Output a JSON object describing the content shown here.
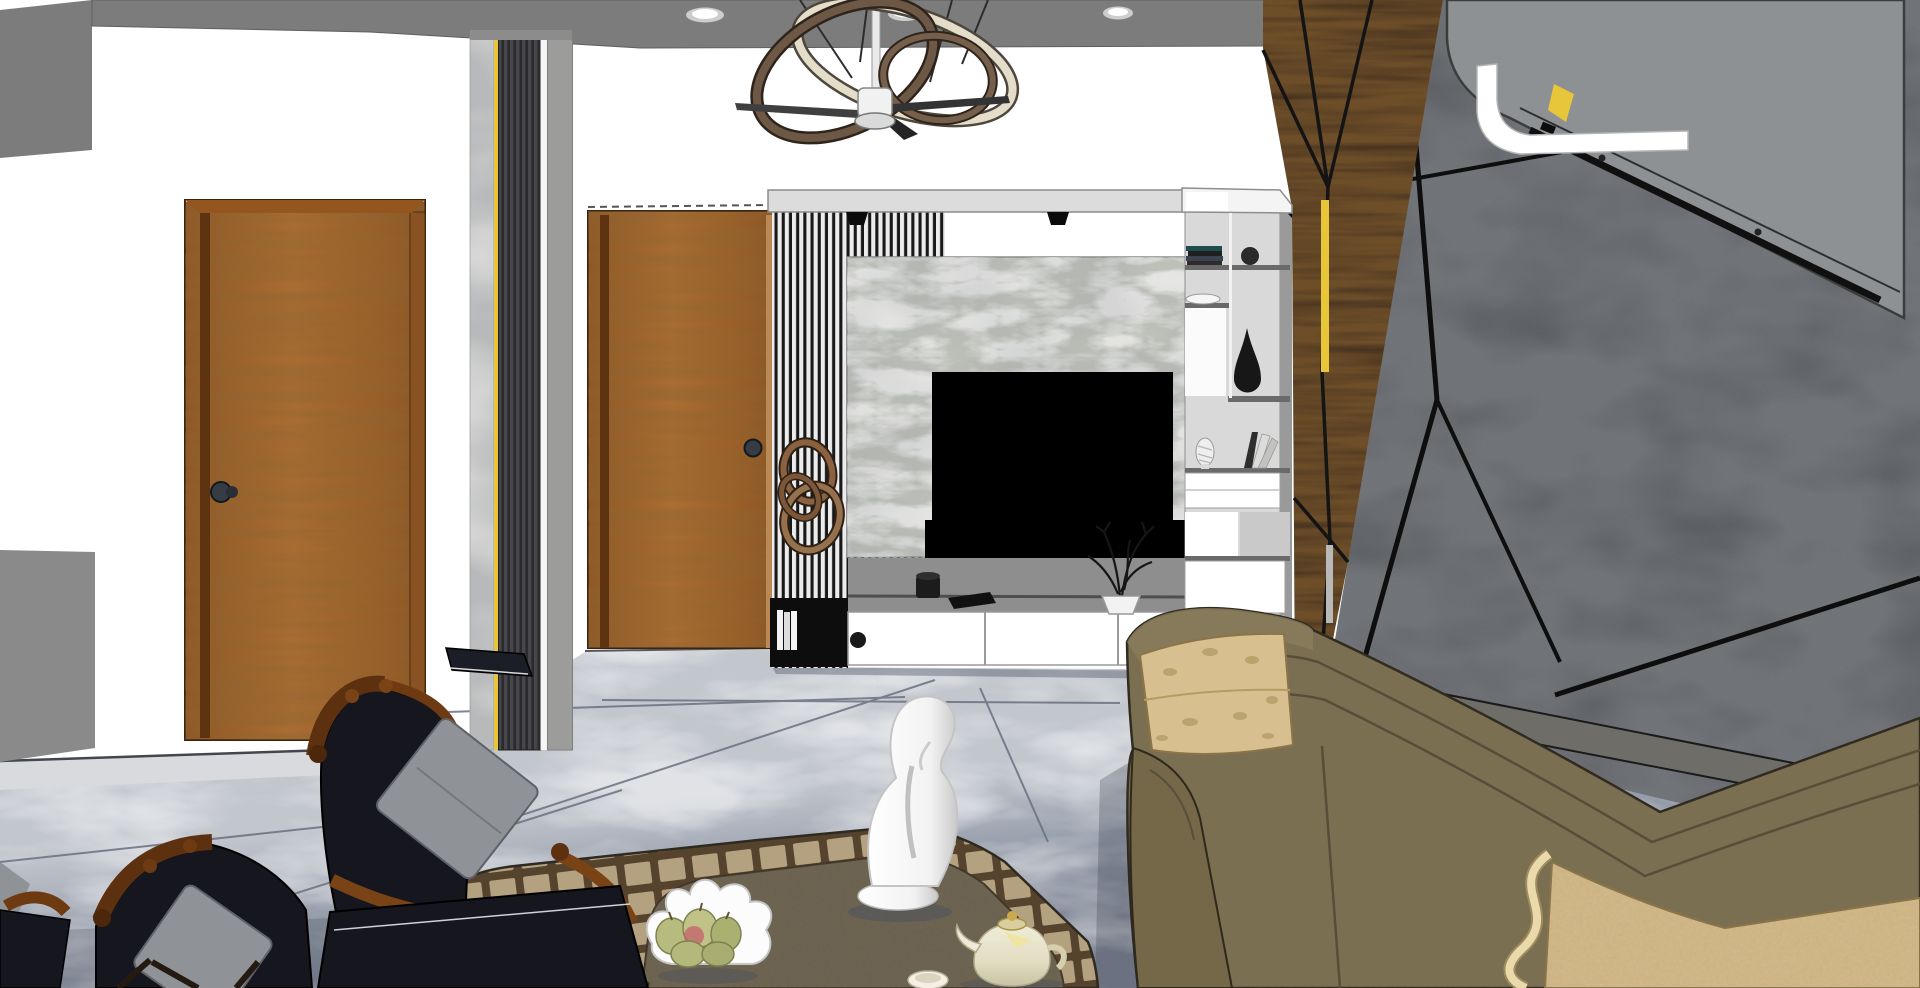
{
  "scene": {
    "description": "3D SketchUp-style rendering of a modern living room interior: white ceiling with gray border band and recessed lights, interlocking-ring chandelier with ceiling fan, two brown wooden doors separated by a marble, gold and fluted pillar, a TV feature wall with black-and-white vertical slats, gray marble panel, wall-mounted black TV and white low cabinet, a white display shelving column with books, bowls and a black teardrop vase, a dark charcoal faceted accent wall with walnut wood triangles and brass strips, a wall-mounted air conditioner, gray marble tile flooring, a brown bordered area rug with a white abstract sculpture, fruit bowl and teapot, two antique navy armchairs and an olive-green fabric sofa.",
    "render_style": "sketchup",
    "room_type": "living room"
  },
  "objects": [
    {
      "id": "ceiling-band",
      "label": "gray ceiling border with recessed lights"
    },
    {
      "id": "chandelier",
      "label": "interlocking ring chandelier with ceiling fan"
    },
    {
      "id": "door-left",
      "label": "wooden door (left wall)"
    },
    {
      "id": "door-center",
      "label": "wooden door (entry)"
    },
    {
      "id": "pillar-strips",
      "label": "marble / gold / fluted pillar"
    },
    {
      "id": "tv-wall",
      "label": "slat and marble TV feature wall"
    },
    {
      "id": "tv",
      "label": "wall mounted television"
    },
    {
      "id": "tv-cabinet",
      "label": "white low media cabinet"
    },
    {
      "id": "shelf-unit",
      "label": "white display shelving column"
    },
    {
      "id": "accent-wall",
      "label": "faceted charcoal and walnut accent wall"
    },
    {
      "id": "air-conditioner",
      "label": "wall mounted air conditioner"
    },
    {
      "id": "floor",
      "label": "gray marble tile floor"
    },
    {
      "id": "rug",
      "label": "brown bordered area rug"
    },
    {
      "id": "sculpture",
      "label": "white abstract kneeling sculpture"
    },
    {
      "id": "fruit-bowl",
      "label": "petal bowl with pears"
    },
    {
      "id": "teapot",
      "label": "cream and gold teapot"
    },
    {
      "id": "armchairs",
      "label": "antique navy armchairs"
    },
    {
      "id": "sofa",
      "label": "olive fabric sofa"
    }
  ],
  "colors": {
    "wall_white": "#ffffff",
    "ceiling_gray": "#7c7c7c",
    "cornice_gray": "#dcdcdc",
    "door_wood": "#a4652f",
    "door_wood_dark": "#7c471c",
    "door_knob": "#363c44",
    "gold_accent": "#e8c63a",
    "slat_light": "#ededed",
    "slat_dark": "#191919",
    "marble_panel": "#c6c9c0",
    "marble_pillar": "#e9e9e7",
    "tv_black": "#000000",
    "shelf_body": "#d9d9d9",
    "shelf_slab": "#6a6a6a",
    "vase_black": "#171717",
    "wood_facet": "#3d2c1d",
    "concrete_wall": "#515458",
    "ac_body": "#8e9194",
    "floor_light": "#bfc3ca",
    "floor_dark": "#848a99",
    "rug_border": "#b3a17f",
    "rug_grid": "#54422d",
    "rug_field": "#6a6150",
    "chair_wood": "#7a4316",
    "chair_navy": "#15161e",
    "pillow_gray": "#8f9296",
    "sofa_olive": "#7b6f52",
    "sofa_tan": "#d8bf90",
    "sofa_piping": "#ead9ab",
    "sculpture_white": "#fdfdfd",
    "teapot_cream": "#f1eedd",
    "pear_green": "#b7bb7d"
  }
}
